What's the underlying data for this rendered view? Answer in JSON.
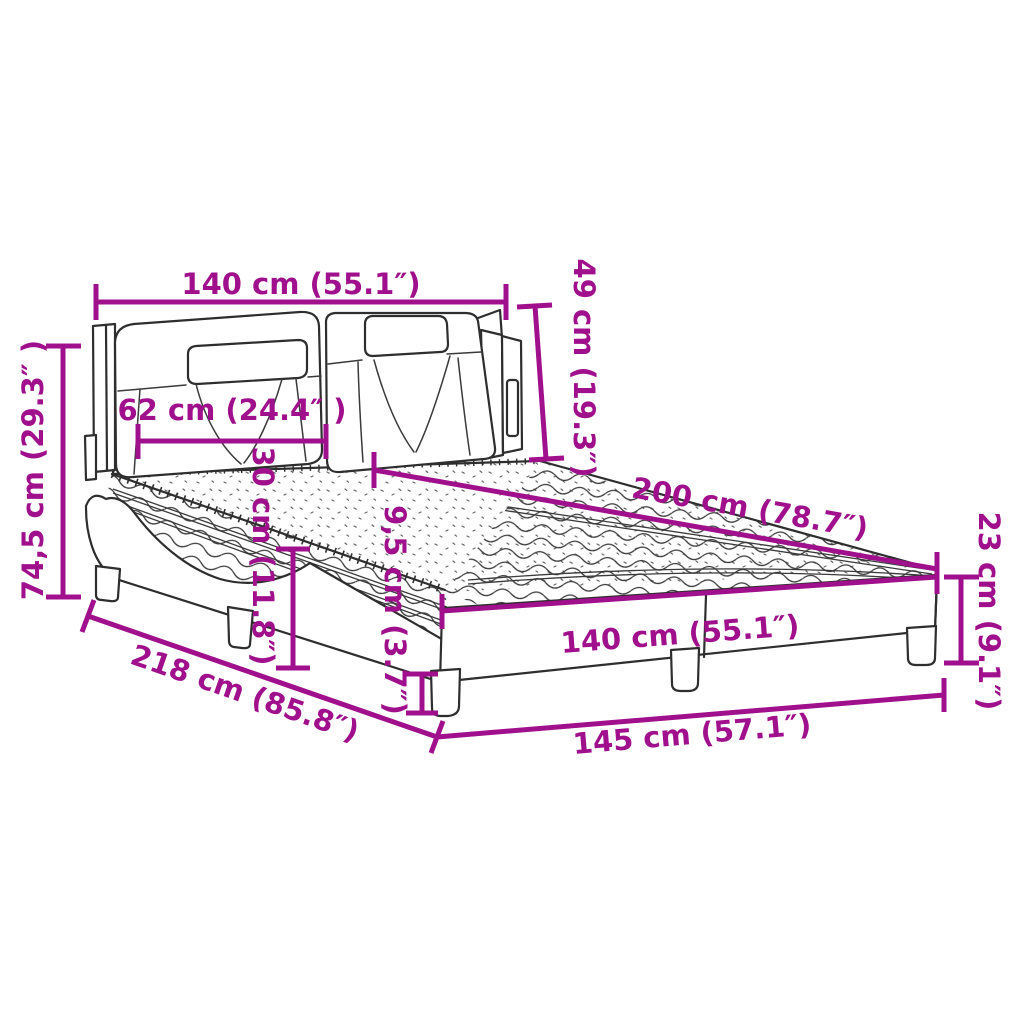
{
  "diagram": {
    "type": "product-dimension-diagram",
    "product": "upholstered-bed-with-mattress",
    "accent_color": "#A1108C",
    "line_color": "#2e2e2e",
    "background_color": "#ffffff",
    "dimensions": {
      "headboard_width_top": "140 cm (55.1″)",
      "headboard_upper_height": "49 cm (19.3″)",
      "total_height": "74,5 cm (29.3″ )",
      "cushion_width": "62 cm (24.4″ )",
      "mattress_thickness": "30 cm (11.8″)",
      "rail_min_height": "9,5 cm (3.7″)",
      "mattress_length": "200 cm (78.7″)",
      "frame_height": "23 cm (9.1″)",
      "mattress_width": "140 cm (55.1″)",
      "total_length": "218 cm (85.8″)",
      "total_width": "145 cm (57.1″)"
    }
  }
}
